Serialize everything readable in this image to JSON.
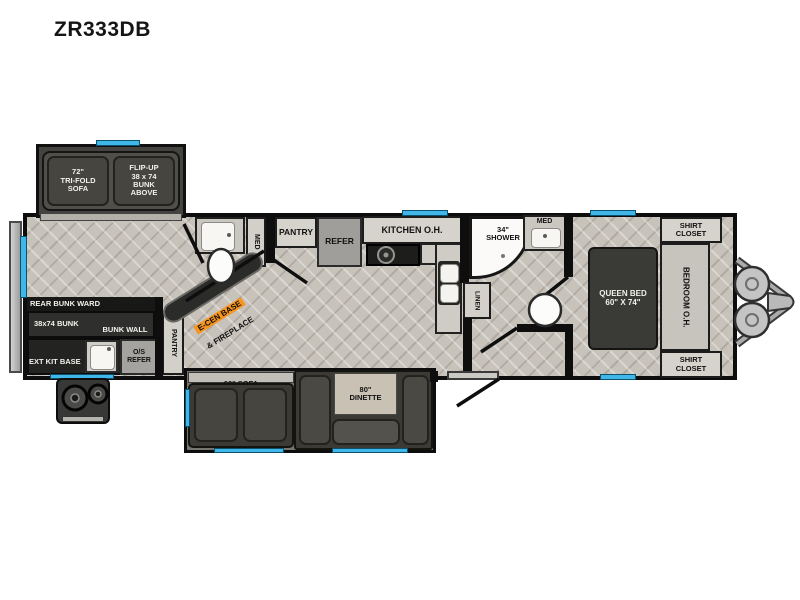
{
  "model": "ZR333DB",
  "regions": {
    "rear_slide": {
      "sofa": "72\"\nTRI-FOLD\nSOFA",
      "bunk": "FLIP-UP\n38 x 74\nBUNK\nABOVE"
    },
    "bunk_room": {
      "ward": "REAR BUNK WARD",
      "bunk": "38x74 BUNK",
      "bunk_wall": "BUNK WALL",
      "ext_kit": "EXT KIT BASE",
      "os_refer": "O/S\nREFER",
      "pantry": "PANTRY"
    },
    "rear_bath": {
      "med": "MED"
    },
    "entertainment": {
      "base": "E-CEN BASE",
      "fireplace": "& FIREPLACE"
    },
    "galley": {
      "pantry": "PANTRY",
      "refer": "REFER",
      "kitchen_oh": "KITCHEN O.H."
    },
    "bath": {
      "shower": "34\"\nSHOWER",
      "linen": "LINEN",
      "med": "MED"
    },
    "bedroom": {
      "bed": "QUEEN BED\n60\" X 74\"",
      "oh": "BEDROOM O.H.",
      "shirt_closet": "SHIRT\nCLOSET"
    },
    "main_slide": {
      "sofa": "60\" SOFA",
      "dinette": "80\"\nDINETTE"
    }
  },
  "colors": {
    "window_blue": "#41b6e8",
    "wall_black": "#0e0e0e",
    "ecen_orange": "#f7941d",
    "furniture_dark": "#3b3a36",
    "cabinet_light": "#d6d3cd",
    "floor_gray": "#c7c2ba"
  }
}
